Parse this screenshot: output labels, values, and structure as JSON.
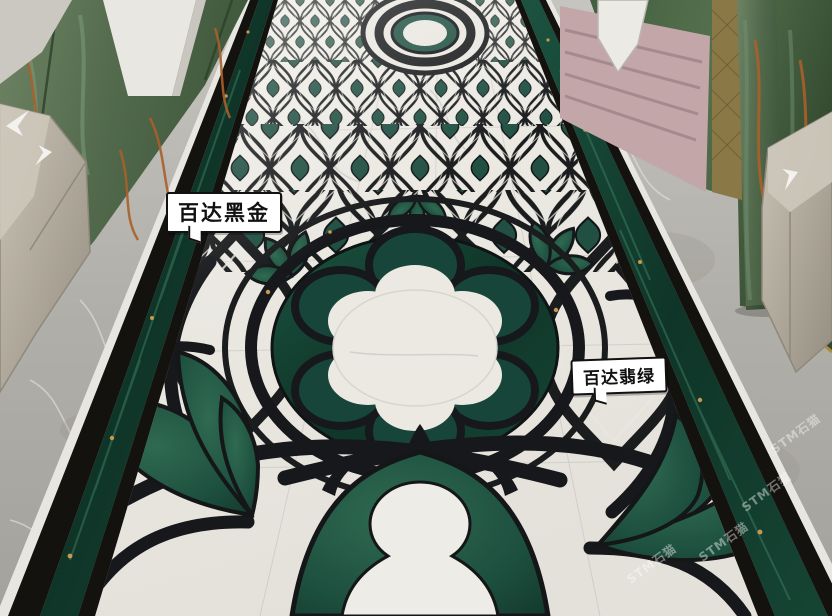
{
  "callouts": [
    {
      "id": "black-gold",
      "label": "百达黑金"
    },
    {
      "id": "jade-green",
      "label": "百达翡绿"
    }
  ],
  "watermark": {
    "text": "STM石猫"
  },
  "palette": {
    "marble_white": "#edeae4",
    "marble_black": "#17181b",
    "inlay_green": "#1d4f3e",
    "border_green": "#123c30",
    "gold_fleck": "#c59a4e",
    "floor_grey": "#b3b1ac",
    "wall_green": "#58714f",
    "wall_vein_orange": "#a8602a",
    "pillar_white": "#e9e7e1",
    "niche_pink": "#c3a6a8",
    "mesh_gold": "#8a7847",
    "desk_grey": "#b2ab9f"
  }
}
